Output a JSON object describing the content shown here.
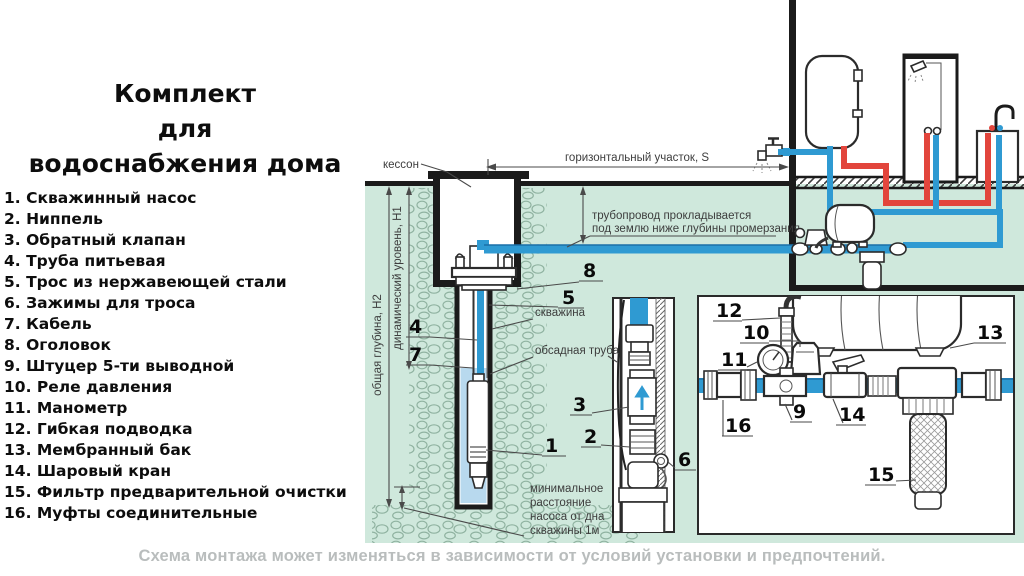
{
  "title": {
    "line1": "Комплект",
    "line2": "для",
    "line3": "водоснабжения дома"
  },
  "parts_list": {
    "items": [
      "1. Скважинный насос",
      "2. Ниппель",
      "3. Обратный клапан",
      "4. Труба питьевая",
      "5. Трос из нержавеющей стали",
      "6. Зажимы для троса",
      "7. Кабель",
      "8. Оголовок",
      "9. Штуцер 5-ти выводной",
      "10. Реле давления",
      "11. Манометр",
      "12. Гибкая подводка",
      "13. Мембранный бак",
      "14. Шаровый кран",
      "15. Фильтр предварительной очистки",
      "16. Муфты соединительные"
    ]
  },
  "diagram": {
    "labels": {
      "caisson": "кессон",
      "horizontal_run": "горизонтальный участок,  S",
      "pipe_depth_1": "трубопровод прокладывается",
      "pipe_depth_2": "под землю ниже глубины промерзания",
      "borehole": "скважина",
      "casing_pipe": "обсадная труба",
      "total_depth": "общая глубина, Н2",
      "dynamic_level": "динамический уровень, Н1",
      "min_dist_1": "минимальное",
      "min_dist_2": "расстояние",
      "min_dist_3": "насоса от дна",
      "min_dist_4": "скважины 1м"
    },
    "callouts": {
      "n1": "1",
      "n2": "2",
      "n3": "3",
      "n4": "4",
      "n5": "5",
      "n6": "6",
      "n7": "7",
      "n8": "8",
      "n9": "9",
      "n10": "10",
      "n11": "11",
      "n12": "12",
      "n13": "13",
      "n14": "14",
      "n15": "15",
      "n16": "16"
    }
  },
  "footer": {
    "caption": "Схема монтажа может изменяться в зависимости от условий установки и предпочтений."
  },
  "colors": {
    "ground": "#cfe8dc",
    "pipe_cold": "#2f9ad2",
    "pipe_cold_dark": "#1a6fa8",
    "pipe_hot": "#e2453c",
    "water": "#b8d9ee",
    "stone_outline": "#8fb2a0",
    "caption": "#b9bdbd"
  }
}
